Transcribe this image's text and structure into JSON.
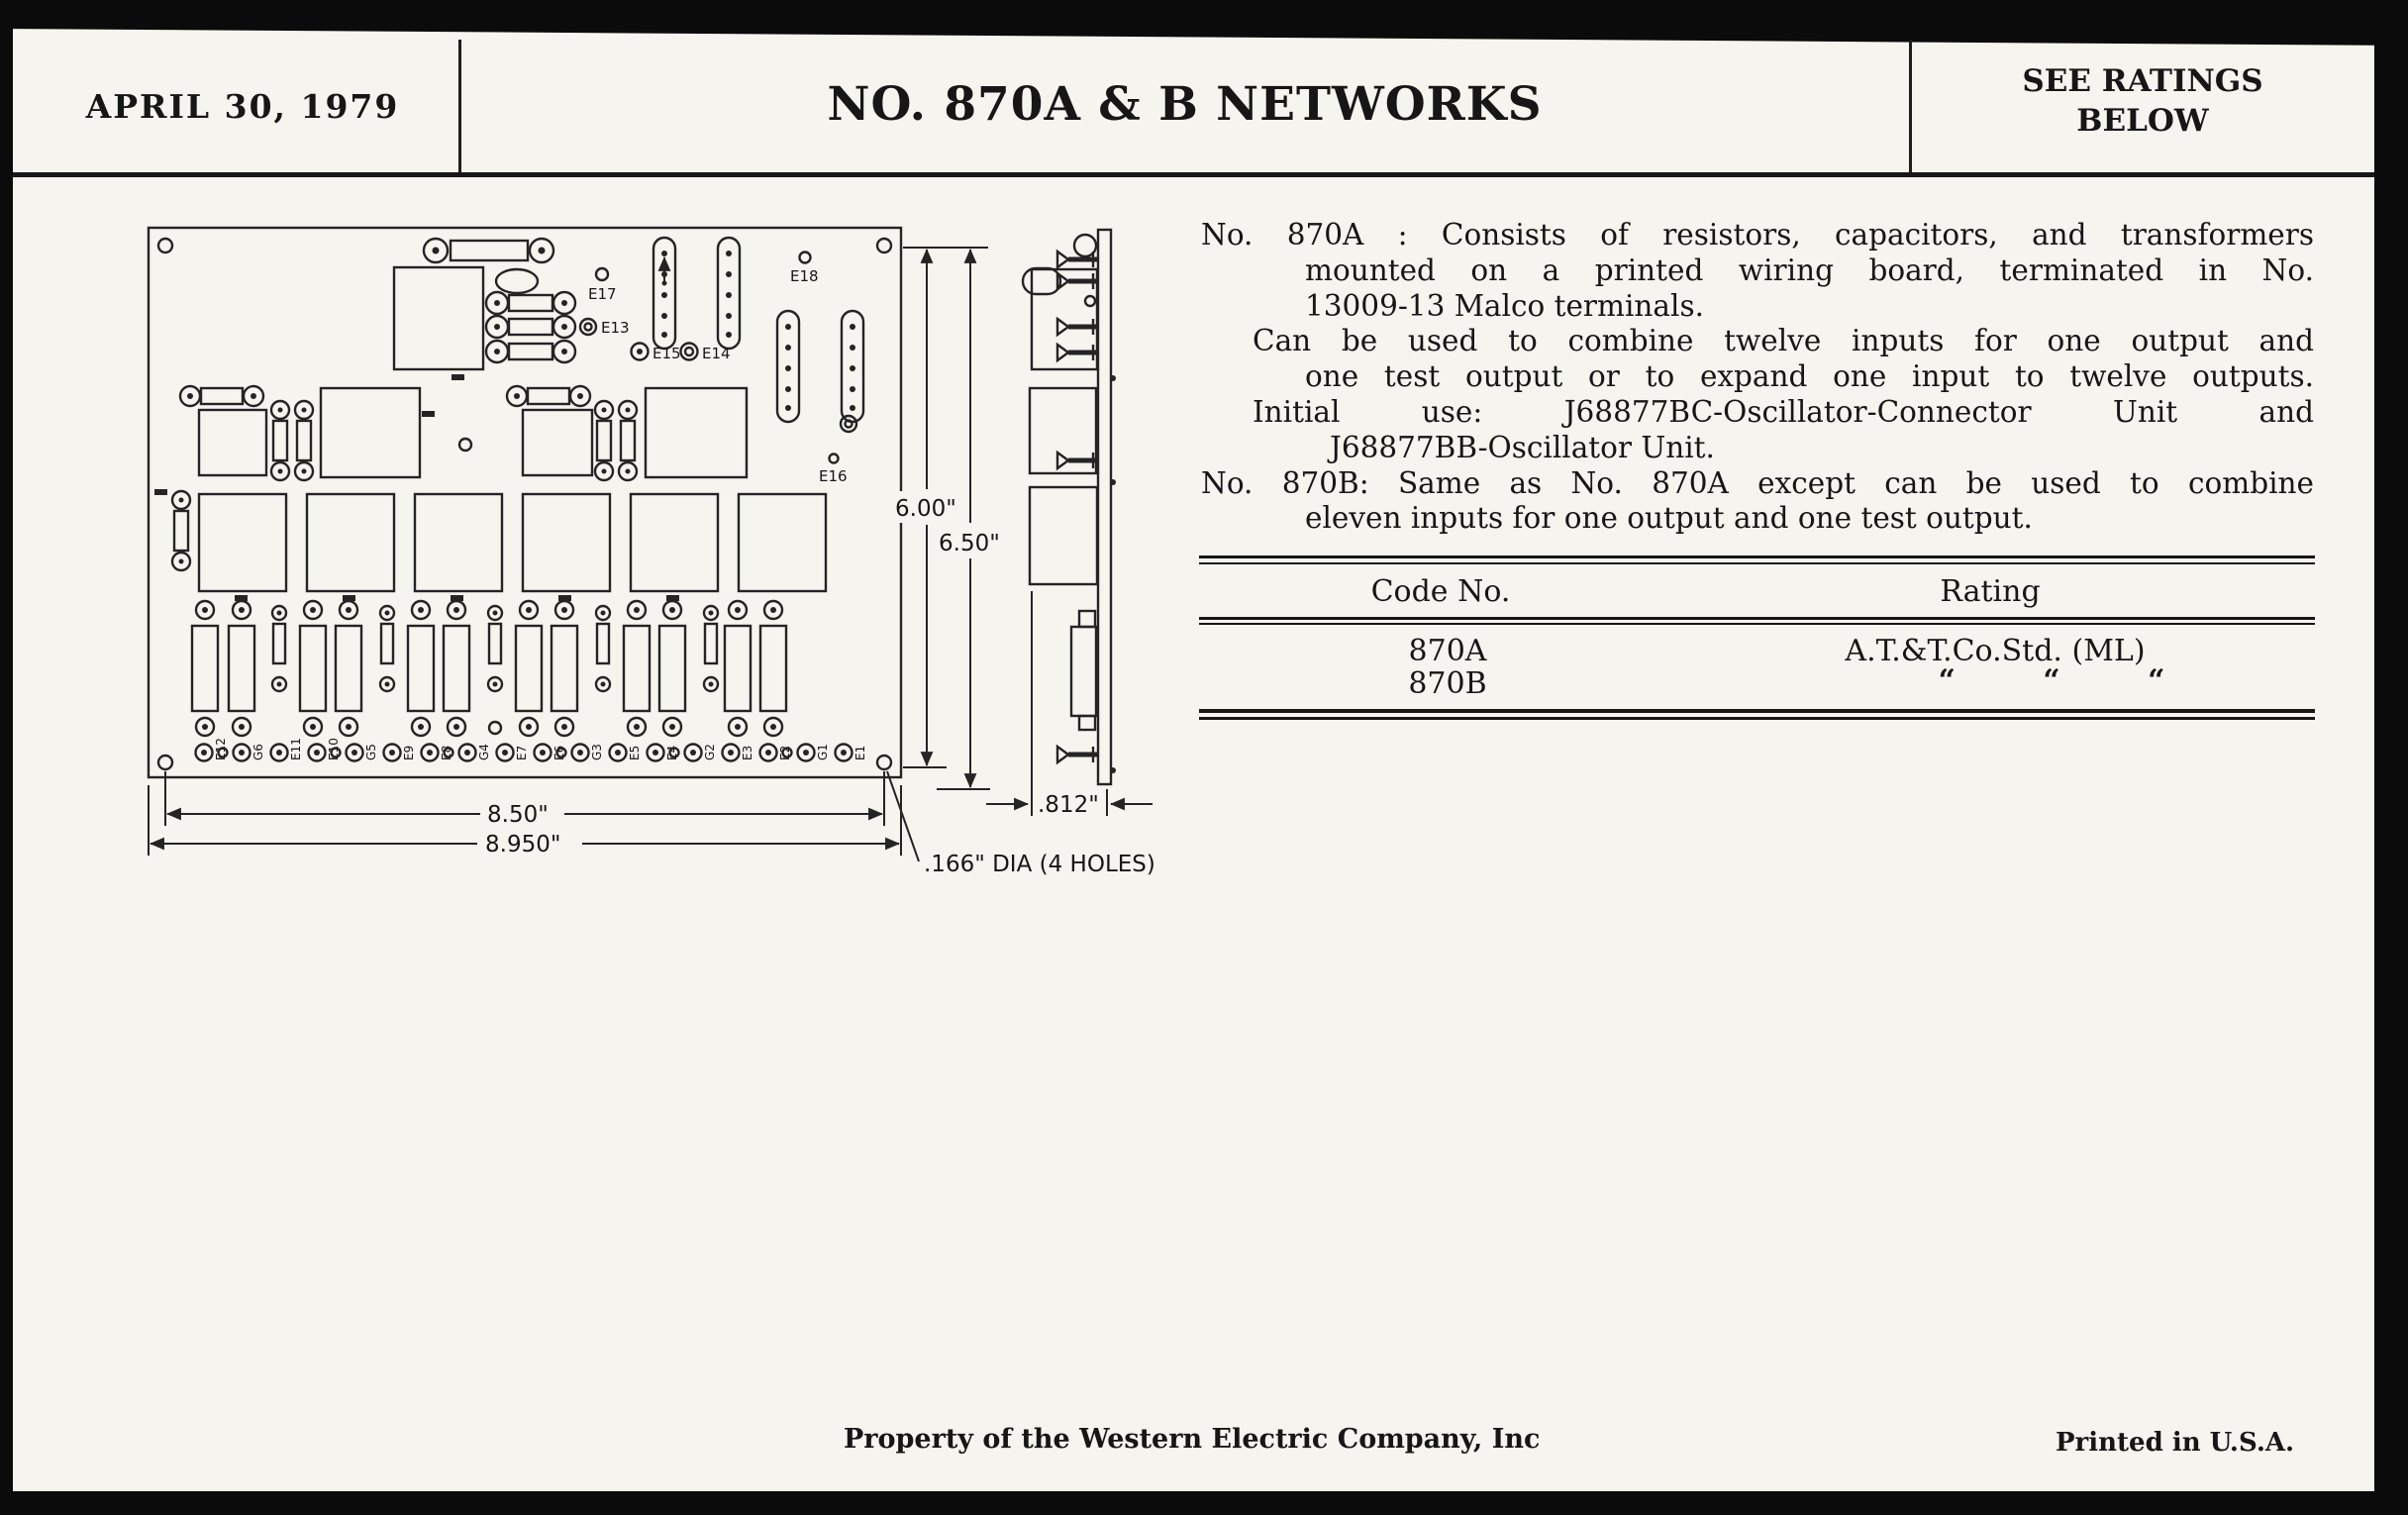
{
  "header": {
    "date": "APRIL 30, 1979",
    "title": "NO. 870A & B NETWORKS",
    "ratings_note_line1": "SEE RATINGS",
    "ratings_note_line2": "BELOW"
  },
  "description": {
    "lines": [
      "No. 870A :  Consists of resistors, capacitors, and transformers",
      "mounted on a printed wiring board, terminated in No.",
      "13009-13 Malco terminals.",
      "Can be used to combine twelve inputs for one output and",
      "one test output or to expand one input to twelve outputs.",
      "Initial use:  J68877BC-Oscillator-Connector Unit and",
      "J68877BB-Oscillator Unit.",
      "No. 870B:  Same as No. 870A except can be used to combine",
      "eleven inputs for one output and one test output."
    ]
  },
  "table": {
    "col1_header": "Code No.",
    "col2_header": "Rating",
    "rows": [
      {
        "code": "870A",
        "rating": "A.T.&T.Co.Std. (ML)"
      },
      {
        "code": "870B",
        "rating": "“ “ “"
      }
    ]
  },
  "drawing": {
    "dim_height_inner": "6.00\"",
    "dim_height_outer": "6.50\"",
    "dim_width_inner": "8.50\"",
    "dim_width_outer": "8.950\"",
    "dim_depth": ".812\"",
    "holes_note": ".166\" DIA (4 HOLES)",
    "labels": {
      "e13": "E13",
      "e14": "E14",
      "e15": "E15",
      "e16": "E16",
      "e17": "E17",
      "e18": "E18"
    },
    "terminals": [
      "E12",
      "G6",
      "E11",
      "E10",
      "G5",
      "E9",
      "E8",
      "G4",
      "E7",
      "E6",
      "G3",
      "E5",
      "E4",
      "G2",
      "E3",
      "E2",
      "G1",
      "E1"
    ]
  },
  "footer": {
    "property": "Property of the Western Electric Company, Inc",
    "printed": "Printed in U.S.A."
  }
}
